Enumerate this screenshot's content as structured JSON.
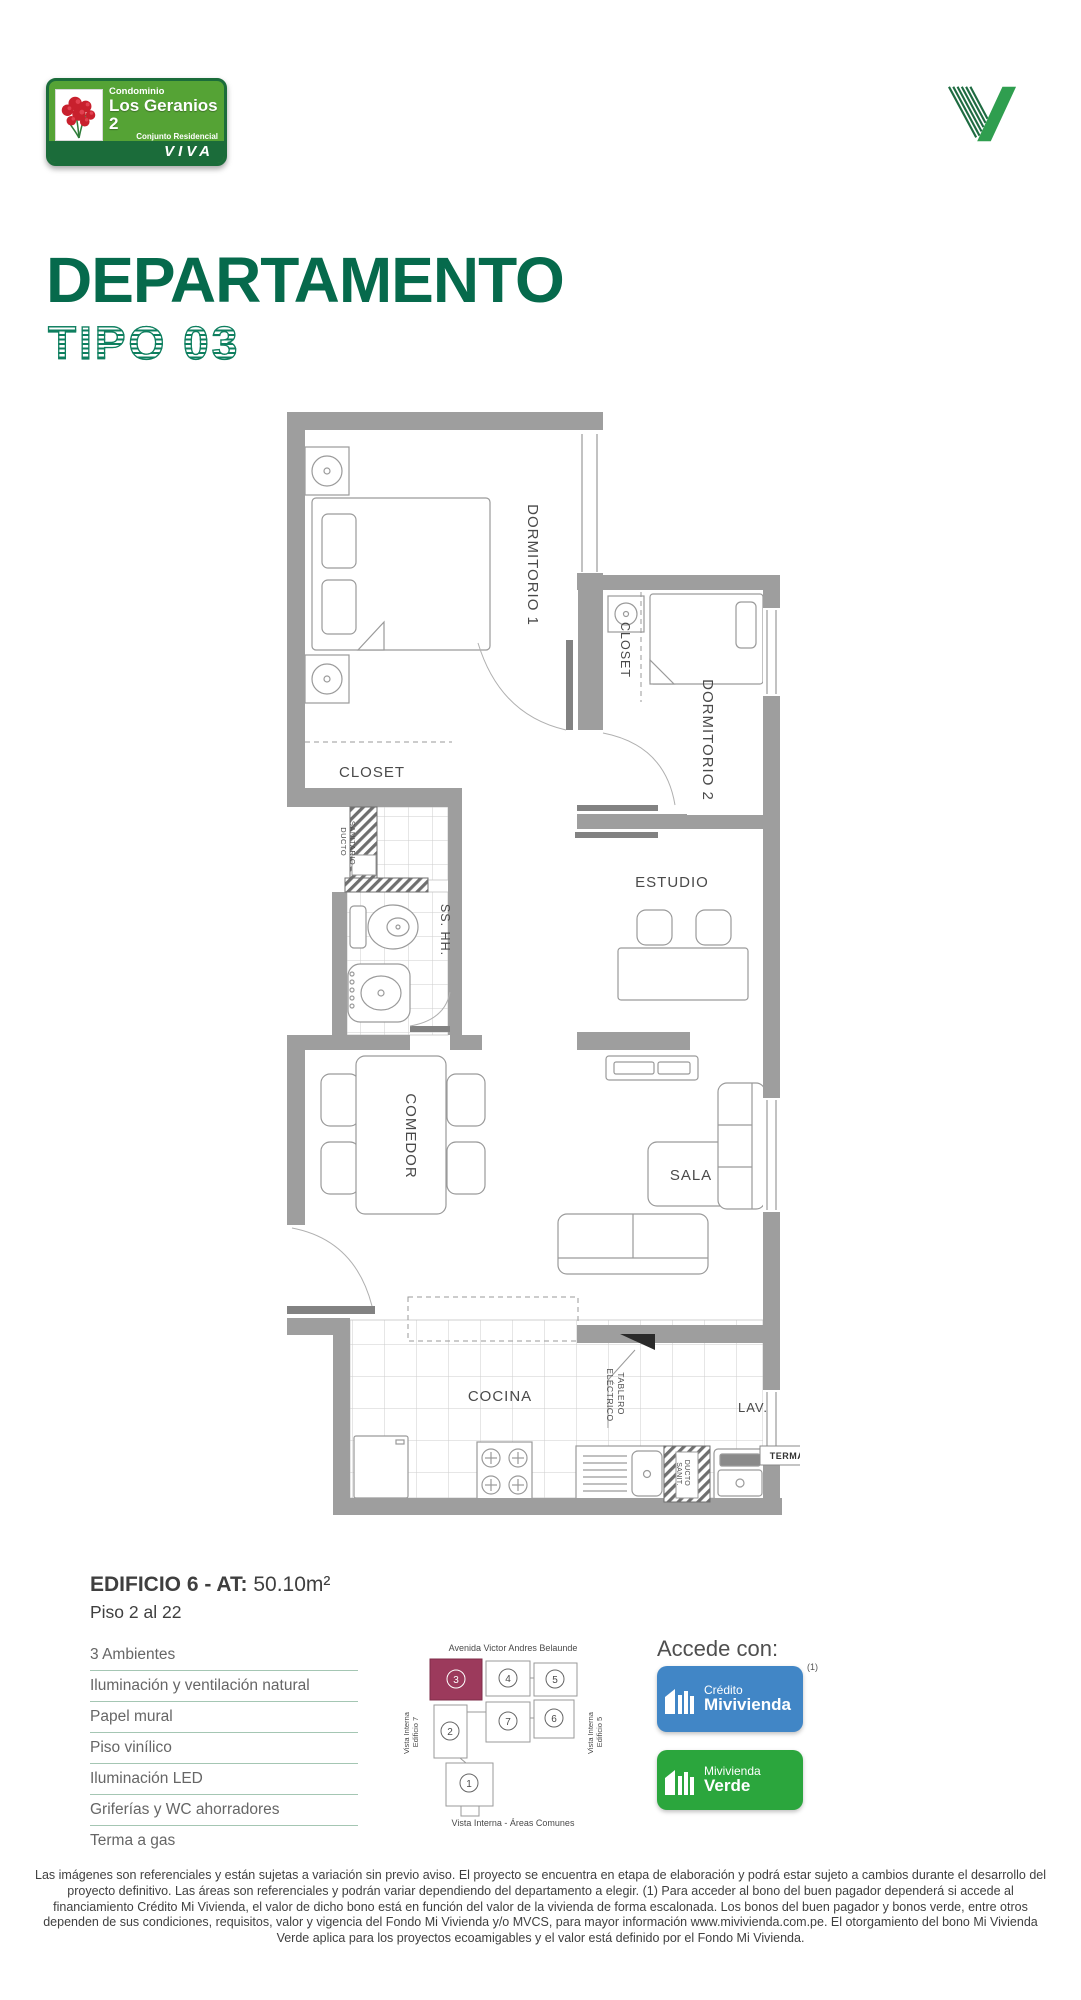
{
  "header": {
    "badge_top": "Condominio",
    "badge_name": "Los Geranios 2",
    "badge_sub": "Conjunto Residencial",
    "badge_brand": "VIVA"
  },
  "title": {
    "main": "DEPARTAMENTO",
    "sub": "TIPO 03"
  },
  "plan": {
    "labels": {
      "dorm1": "DORMITORIO 1",
      "dorm2": "DORMITORIO 2",
      "closet_dorm1": "CLOSET",
      "closet_dorm2": "CLOSET",
      "bath": "SS. HH.",
      "estudio": "ESTUDIO",
      "comedor": "COMEDOR",
      "sala": "SALA",
      "cocina": "COCINA",
      "lav": "LAV.",
      "terma": "TERMA",
      "ducto_line1": "DUCTO",
      "ducto_line2": "SANITARIO",
      "tablero_line1": "TABLERO",
      "tablero_line2": "ELÉCTRICO",
      "ducto2_line1": "DUCTO",
      "ducto2_line2": "SANIT."
    }
  },
  "info": {
    "building": "EDIFICIO 6 - AT:",
    "area": " 50.10m²",
    "floors": "Piso 2 al 22",
    "features": [
      "3 Ambientes",
      "Iluminación y ventilación natural",
      "Papel mural",
      "Piso vinílico",
      "Iluminación LED",
      "Griferías y WC ahorradores",
      "Terma a gas"
    ]
  },
  "siteplan": {
    "street": "Avenida Victor Andres Belaunde",
    "left1": "Vista Interna",
    "left2": "Edificio 7",
    "right1": "Vista Interna",
    "right2": "Edificio 5",
    "bottom": "Vista Interna - Áreas Comunes",
    "u1": "1",
    "u2": "2",
    "u3": "3",
    "u4": "4",
    "u5": "5",
    "u6": "6",
    "u7": "7"
  },
  "access": {
    "heading": "Accede con:",
    "note": "(1)",
    "credito_top": "Crédito",
    "credito_bottom": "Mivivienda",
    "verde_top": "Mivivienda",
    "verde_bottom": "Verde"
  },
  "colors": {
    "brand_green": "#066a4c",
    "badge_green": "#55a335",
    "badge_dark": "#1b6c3a",
    "highlight": "#9c3a5c",
    "credito_blue": "#4186c6",
    "verde_green": "#2ba63d",
    "wall_gray": "#9e9e9e"
  },
  "disclaimer": "Las imágenes son referenciales y están sujetas a variación sin previo aviso. El proyecto se encuentra en etapa de elaboración y podrá estar sujeto a cambios durante el desarrollo del proyecto definitivo. Las áreas son referenciales y podrán variar dependiendo del departamento a elegir. (1) Para acceder al bono del buen pagador dependerá si accede al financiamiento Crédito Mi Vivienda, el valor de dicho bono está en función del valor de la vivienda de forma escalonada. Los bonos del buen pagador y bonos verde, entre otros dependen de sus condiciones, requisitos, valor y vigencia del Fondo Mi Vivienda y/o MVCS, para mayor información www.mivivienda.com.pe. El otorgamiento del bono Mi Vivienda Verde aplica para los proyectos ecoamigables y el valor está definido por el Fondo Mi Vivienda."
}
